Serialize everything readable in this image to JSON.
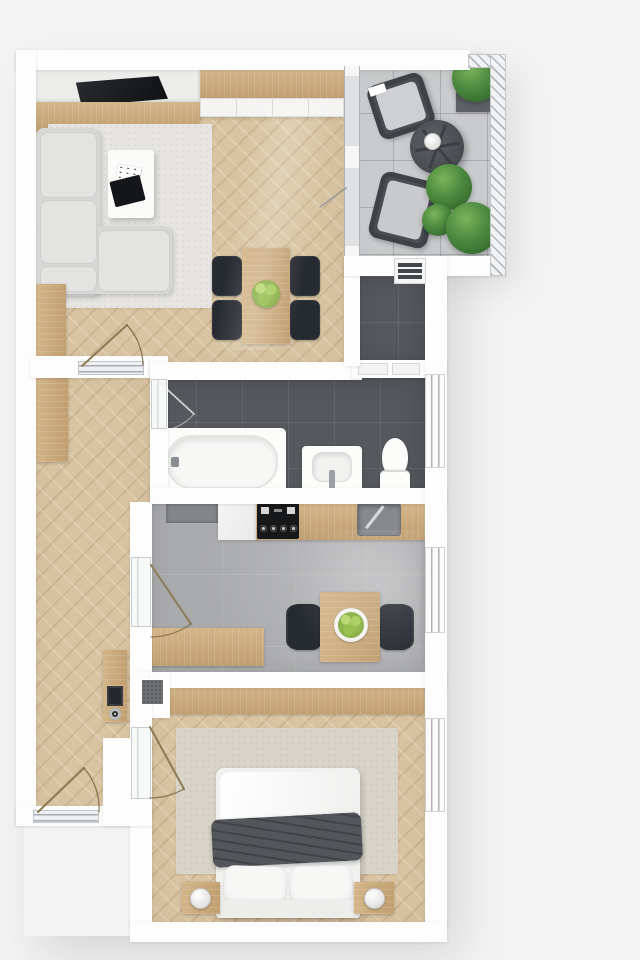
{
  "title": "apartment-floor-plan-3d-top-view",
  "palette": {
    "background": "#f3f3f4",
    "walls": "#fdfdfd",
    "oak_floor": "#d9c4a2",
    "oak_furniture": "#cbaa7c",
    "dark_tile": "#55585d",
    "concrete_floor": "#a9aaac",
    "balcony_tile": "#c9cbcd",
    "sofa": "#d7d7d6",
    "chair_black": "#262a31",
    "duvet": "#53565b",
    "plant_green": "#4c8a3f",
    "apple_green": "#9ac04d",
    "fixture_white": "#fcfcfb"
  },
  "rooms": [
    {
      "name": "living-dining-room",
      "floor": "light-oak-herringbone",
      "furniture": [
        "tv",
        "media-wall",
        "tv-lowboard",
        "sideboard",
        "area-rug",
        "corner-sofa",
        "coffee-table",
        "tray",
        "dining-table",
        "dining-chairs-x4",
        "fruit-bowl",
        "radiator"
      ]
    },
    {
      "name": "balcony",
      "floor": "light-gray-tile",
      "furniture": [
        "lounge-chair-x2",
        "round-table",
        "table-lamp-sphere",
        "planter-box",
        "plant-x3",
        "glass-balustrade"
      ]
    },
    {
      "name": "storage-room",
      "floor": "dark-gray-tile",
      "furniture": []
    },
    {
      "name": "bathroom",
      "floor": "dark-gray-tile",
      "furniture": [
        "bathtub",
        "washbasin",
        "toilet"
      ]
    },
    {
      "name": "kitchen",
      "floor": "gray-concrete-tile",
      "furniture": [
        "kitchen-counter",
        "cooktop",
        "kitchen-sink",
        "appliance",
        "kitchen-table",
        "kitchen-chair-x2",
        "fruit-plate",
        "bench"
      ]
    },
    {
      "name": "hallway",
      "floor": "light-oak-herringbone",
      "furniture": [
        "wardrobe-upper",
        "wardrobe-lower",
        "console-with-intercom",
        "doormat"
      ]
    },
    {
      "name": "bedroom",
      "floor": "light-oak-herringbone",
      "furniture": [
        "double-bed",
        "duvet",
        "pillow-x2",
        "nightstand-x2",
        "lamp-x2",
        "wardrobe",
        "area-rug"
      ]
    }
  ],
  "openings": {
    "windows": [
      "bathroom-window",
      "kitchen-window",
      "bedroom-window"
    ],
    "doors": [
      "entrance-door",
      "living-room-door",
      "bathroom-door",
      "kitchen-door",
      "bedroom-door",
      "balcony-glass-door"
    ]
  }
}
